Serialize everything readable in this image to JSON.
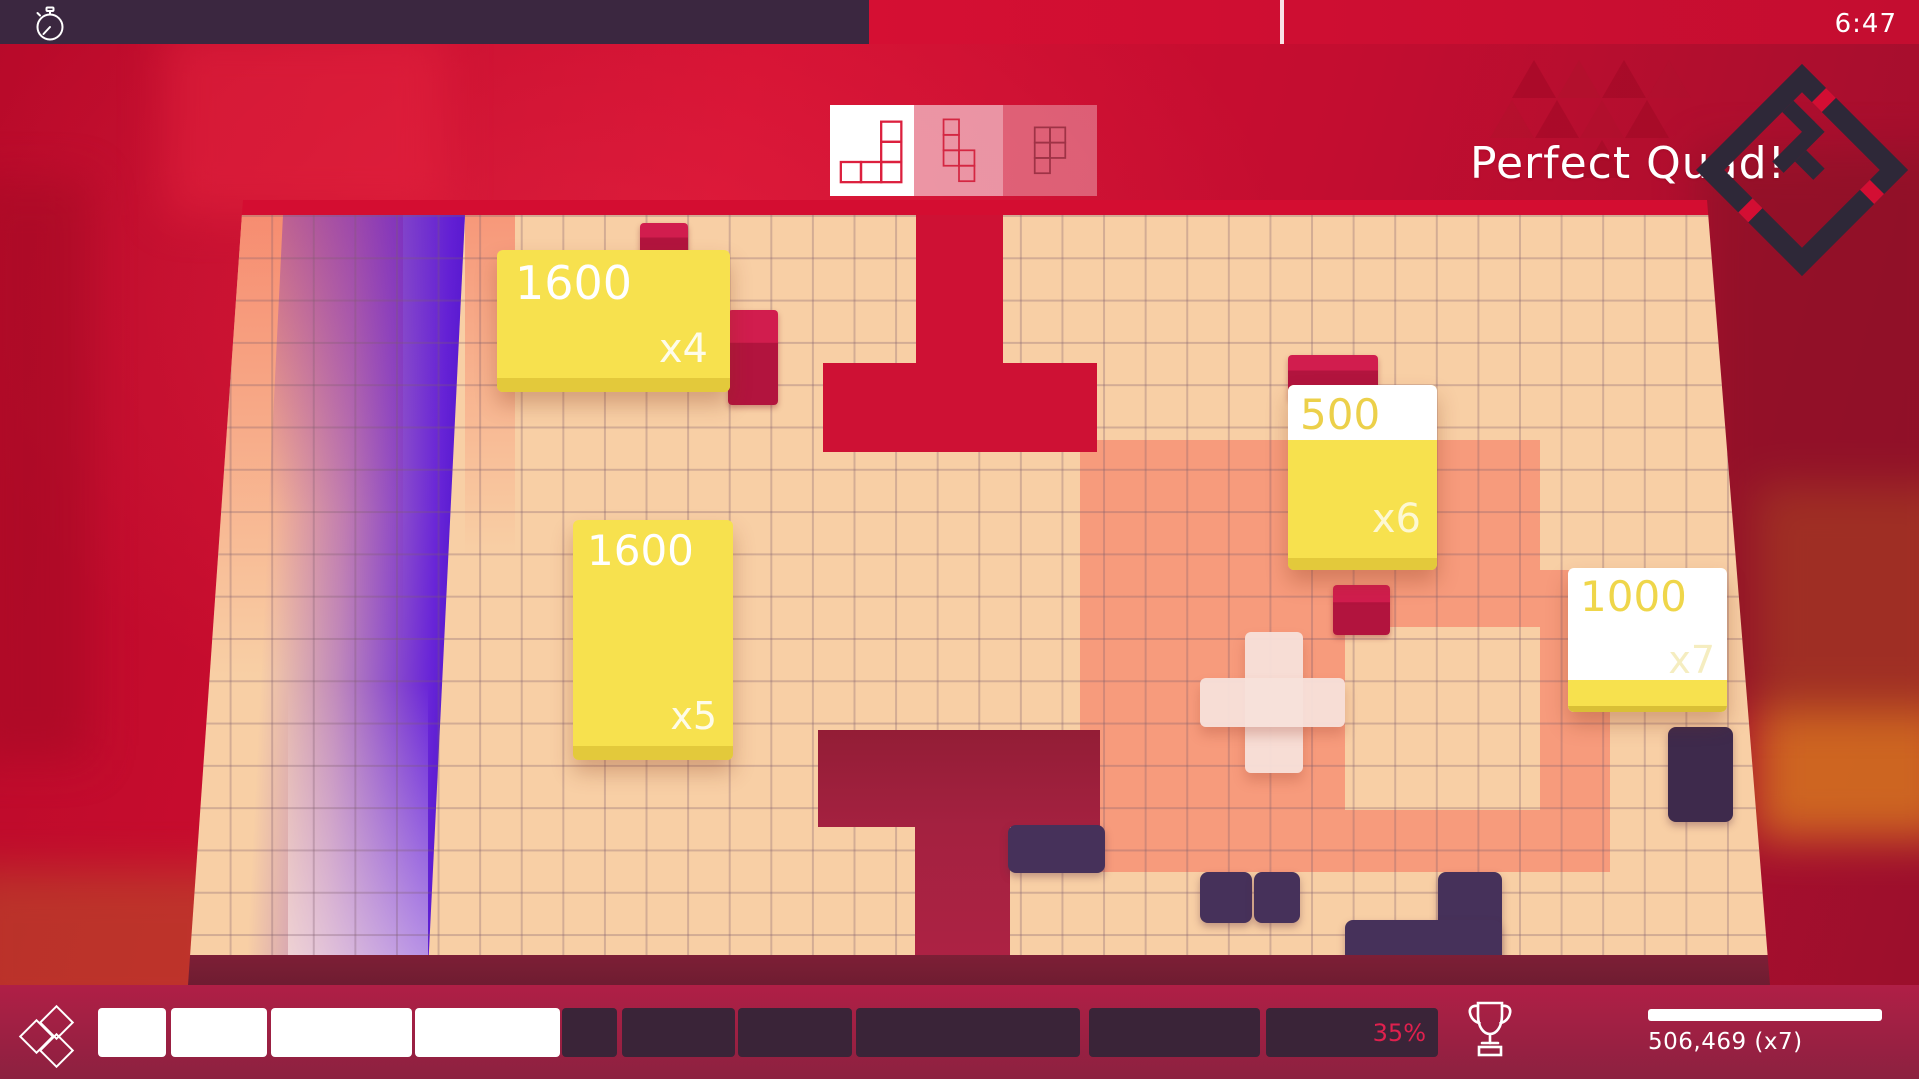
{
  "hud": {
    "timer": "6:47",
    "announcement": "Perfect Quad!",
    "score": "506,469 (x7)",
    "progress_percent": "35%",
    "multiplier_segments": [
      {
        "left": 98,
        "width": 68,
        "filled": true
      },
      {
        "left": 171,
        "width": 96,
        "filled": true
      },
      {
        "left": 271,
        "width": 141,
        "filled": true
      },
      {
        "left": 415,
        "width": 145,
        "filled": true
      },
      {
        "left": 562,
        "width": 55,
        "filled": false
      },
      {
        "left": 622,
        "width": 113,
        "filled": false
      },
      {
        "left": 738,
        "width": 114,
        "filled": false
      },
      {
        "left": 856,
        "width": 224,
        "filled": false
      },
      {
        "left": 1089,
        "width": 171,
        "filled": false
      },
      {
        "left": 1266,
        "width": 172,
        "filled": false
      }
    ]
  },
  "preview": {
    "pieces": [
      {
        "name": "L-pentomino"
      },
      {
        "name": "N-pentomino"
      },
      {
        "name": "P-pentomino"
      }
    ]
  },
  "board": {
    "score_popups": [
      {
        "value": "1600",
        "multiplier": "x4"
      },
      {
        "value": "1600",
        "multiplier": "x5"
      },
      {
        "value": "500",
        "multiplier": "x6"
      },
      {
        "value": "1000",
        "multiplier": "x7"
      }
    ]
  },
  "colors": {
    "accent_yellow": "#f7e14e",
    "crimson_hole": "#ce1134",
    "purple_band": "#6d28d9",
    "piece_dark": "#46315a",
    "salmon": "#f6765f",
    "peach_board": "#f8cfa5",
    "bar_filled": "#ffffff",
    "bar_empty": "#3a2438",
    "progress_text": "#e0204e"
  }
}
